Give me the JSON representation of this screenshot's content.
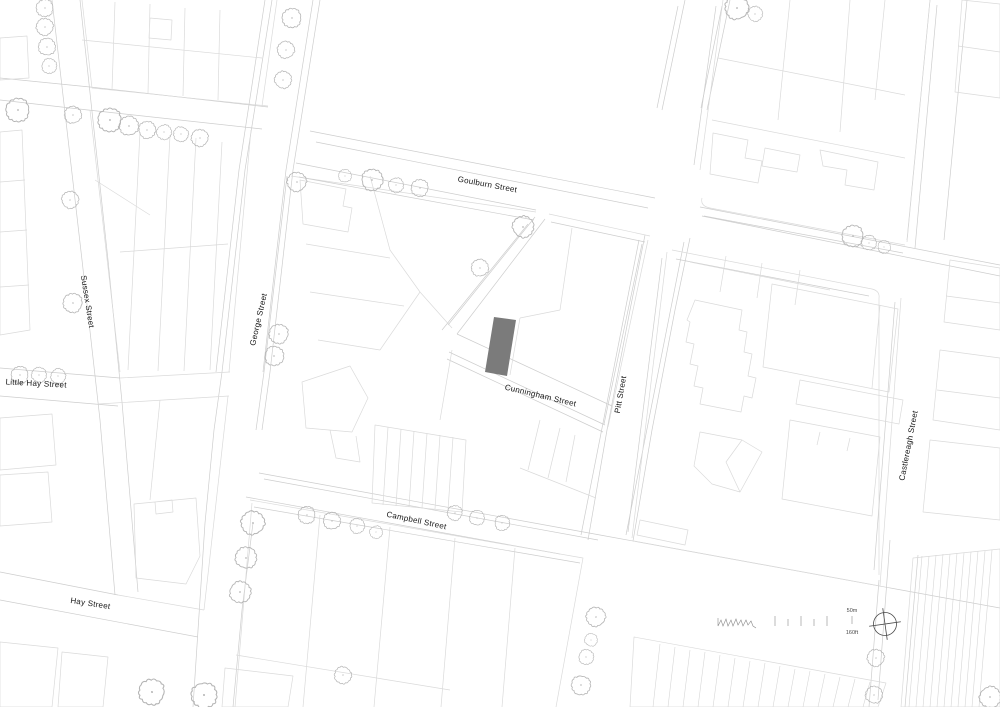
{
  "map": {
    "type_label": "site-plan",
    "streets": [
      {
        "id": "goulburn",
        "name": "Goulburn Street"
      },
      {
        "id": "george",
        "name": "George Street"
      },
      {
        "id": "sussex",
        "name": "Sussex Street"
      },
      {
        "id": "little-hay",
        "name": "Little Hay Street"
      },
      {
        "id": "hay",
        "name": "Hay Street"
      },
      {
        "id": "campbell",
        "name": "Campbell Street"
      },
      {
        "id": "cunningham",
        "name": "Cunningham Street"
      },
      {
        "id": "pitt",
        "name": "Pitt Street"
      },
      {
        "id": "castlereagh",
        "name": "Castlereagh Street"
      }
    ],
    "scale": {
      "metric": "50m",
      "imperial": "160ft"
    },
    "north_symbol": "compass-crosshair",
    "colors": {
      "background": "#ffffff",
      "building_line": "#dadada",
      "street_line": "#cdcdcd",
      "tree_line": "#b5b5b5",
      "highlight_building": "#7b7b7b",
      "label": "#141414"
    }
  }
}
